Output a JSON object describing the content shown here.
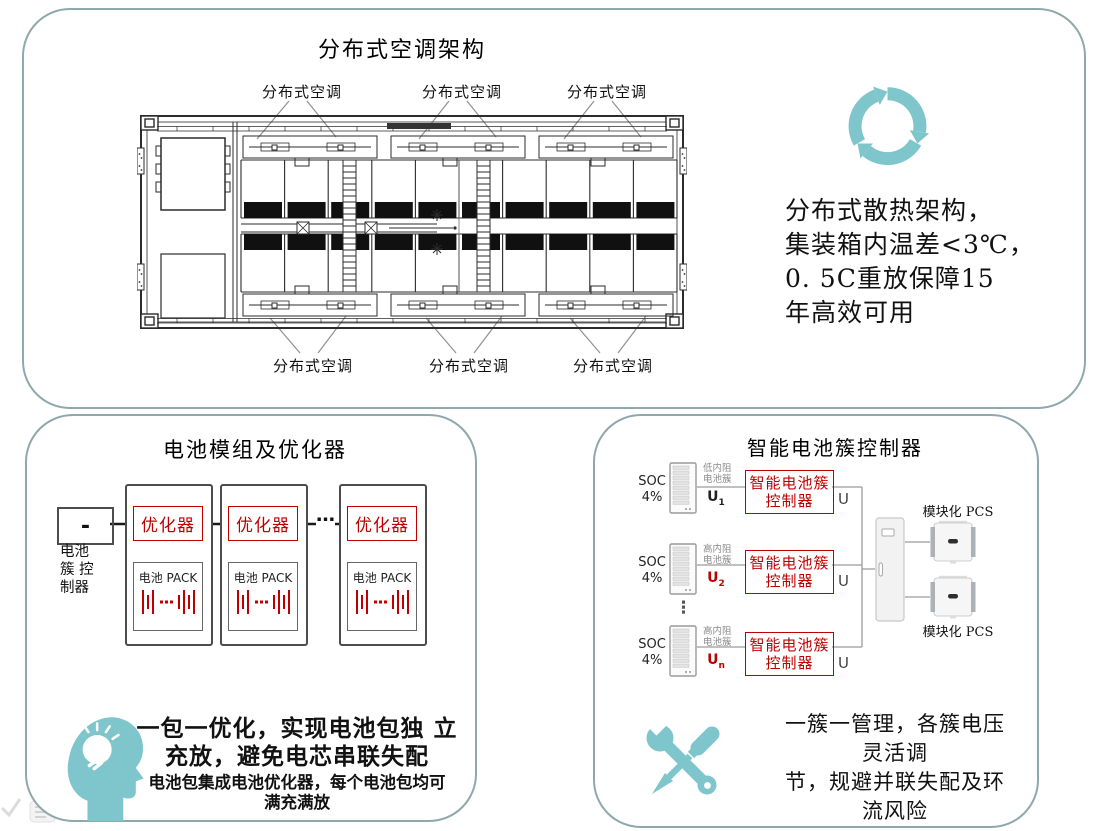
{
  "colors": {
    "accent_teal": "#7EC6CB",
    "panel_border": "#8FA8AB",
    "highlight_red": "#C00000"
  },
  "cooling_panel": {
    "title": "分布式空调架构",
    "top_labels": [
      "分布式空调",
      "分布式空调",
      "分布式空调"
    ],
    "bottom_labels": [
      "分布式空调",
      "分布式空调",
      "分布式空调"
    ],
    "feature": {
      "icon": "recycle-icon",
      "lines": [
        "分布式散热架构，",
        "集装箱内温差<3℃，",
        "0. 5C重放保障15",
        "年高效可用"
      ]
    }
  },
  "optimizer_panel": {
    "title": "电池模组及优化器",
    "controller": {
      "symbol": "-",
      "label_lines": [
        "电池",
        "簇 控",
        "制器"
      ]
    },
    "module": {
      "optimizer": "优化器",
      "pack": "电池 PACK"
    },
    "ellipsis": "…",
    "note": {
      "icon": "idea-head-icon",
      "main_lines": [
        "一包一优化，实现电池包独 立",
        "充放，避免电芯串联失配"
      ],
      "sub_lines": [
        "电池包集成电池优化器，每个电池包均可",
        "满充满放"
      ]
    }
  },
  "cluster_panel": {
    "title": "智能电池簇控制器",
    "soc_label": "SOC",
    "soc_value": "4%",
    "controller_lines": [
      "智能电池簇",
      "控制器"
    ],
    "output_label": "U",
    "rows": [
      {
        "cluster_lines": [
          "低内阻",
          "电池簇"
        ],
        "u": "U",
        "u_sub": "1"
      },
      {
        "cluster_lines": [
          "高内阻",
          "电池簇"
        ],
        "u": "U",
        "u_sub": "2"
      },
      {
        "cluster_lines": [
          "高内阻",
          "电池簇"
        ],
        "u": "U",
        "u_sub": "n"
      }
    ],
    "vertical_ellipsis": "⋮",
    "pcs_label_top": "模块化 PCS",
    "pcs_label_bottom": "模块化 PCS",
    "note": {
      "icon": "tools-icon",
      "lines": [
        "一簇一管理，各簇电压",
        "灵活调",
        "节，规避并联失配及环",
        "流风险"
      ]
    }
  }
}
